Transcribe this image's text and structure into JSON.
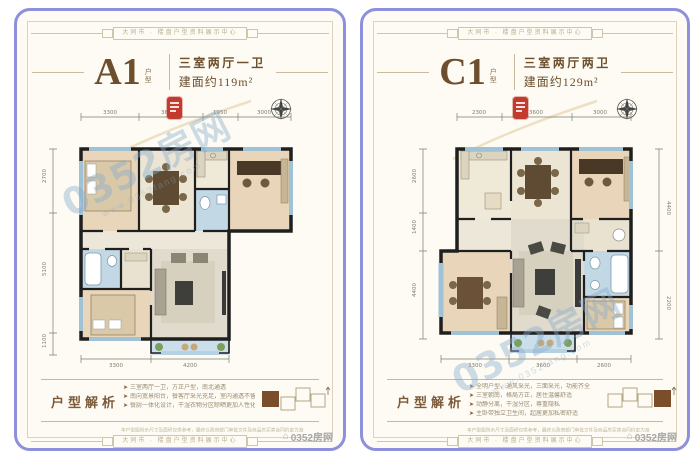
{
  "ribbon_text": "大同市 · 楼盘户型资料展示中心",
  "watermark": {
    "text": "0352房网",
    "url": "www.0352fang.com",
    "logo_text": "0352房网"
  },
  "disclaimer": "本户型图所示尺寸及面积仅供参考，最终以政府部门审批文件及商品房买卖合同约定为准",
  "colors": {
    "card_border": "#8d90da",
    "card_bg": "#fdfbf3",
    "accent_brown": "#6d4e2d",
    "seal_red": "#c23b2e",
    "watermark_blue": "#87acd0",
    "wall_black": "#1f1f1f",
    "bath_blue": "#c2d8e5",
    "balcony_blue": "#cadfeb",
    "bedroom_tan": "#e8d5ba"
  },
  "cards": [
    {
      "unit": "A1",
      "unit_suffix_1": "户",
      "unit_suffix_2": "型",
      "desc_rooms": "三室两厅一卫",
      "desc_area": "建面约119m²",
      "analysis_title": "户型解析",
      "bullets": [
        "三室两厅一卫，方正户型，南北通透",
        "南向宽景阳台，餐客厅采光充足，室内通透不留死角，视野开阔",
        "餐厨一体化设计，干湿衣物分区晾晒更加人性化，增添了居家人的生活舒适与温馨"
      ],
      "plan": {
        "dims_top": [
          "3300",
          "3600",
          "1950",
          "3000"
        ],
        "dims_left": [
          "2700",
          "5100",
          "1100"
        ],
        "dims_bottom": [
          "3300",
          "4200"
        ]
      }
    },
    {
      "unit": "C1",
      "unit_suffix_1": "户",
      "unit_suffix_2": "型",
      "desc_rooms": "三室两厅两卫",
      "desc_area": "建面约129m²",
      "analysis_title": "户型解析",
      "bullets": [
        "全明户型，通风采光，三面采光，功能齐全",
        "三室朝南，格局方正，居住温馨舒适",
        "动静分离，干湿分区，尊重隐私",
        "主卧带独立卫生间，起居更加私密舒适"
      ],
      "plan": {
        "dims_top": [
          "2300",
          "3600",
          "3000"
        ],
        "dims_left": [
          "2600",
          "1400",
          "4400"
        ],
        "dims_right": [
          "4400",
          "2200"
        ],
        "dims_bottom": [
          "3300",
          "3600",
          "2600"
        ]
      }
    }
  ]
}
